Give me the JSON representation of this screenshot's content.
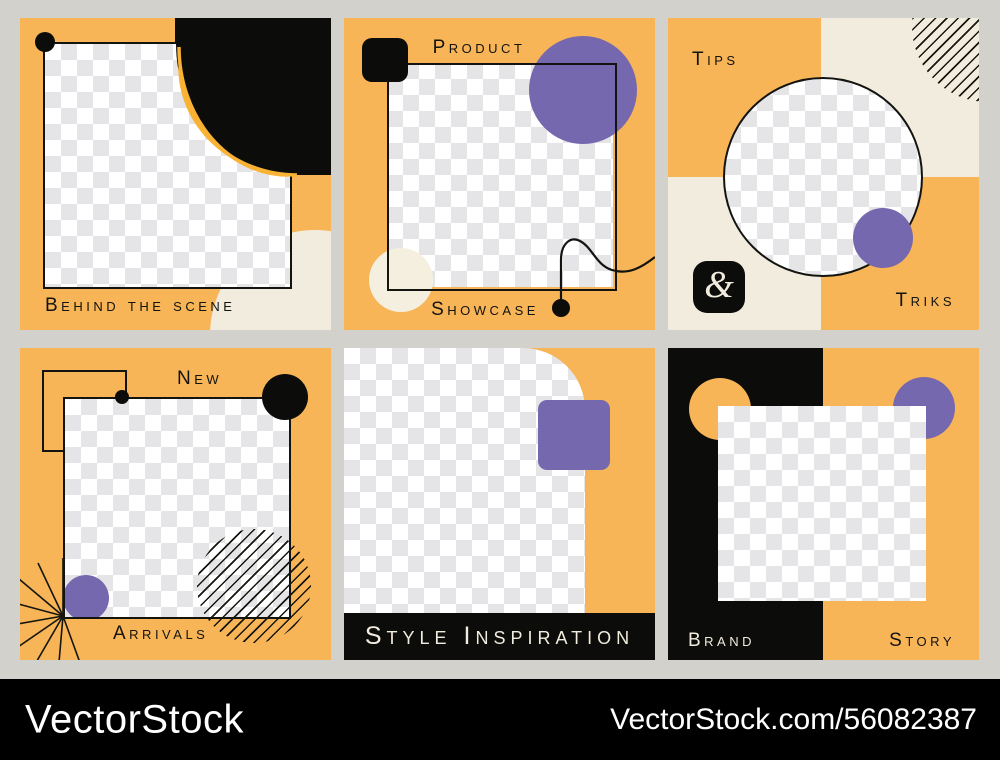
{
  "palette": {
    "background_gray": "#d2d1cc",
    "orange": "#f7b557",
    "purple": "#7568ae",
    "cream": "#f2ecde",
    "black": "#0c0c0a",
    "arc_yellow": "#f9b233"
  },
  "cards": {
    "behind_the_scene": {
      "label": "Behind the scene"
    },
    "product_showcase": {
      "label_top": "Product",
      "label_bottom": "Showcase"
    },
    "tips_triks": {
      "label_top": "Tips",
      "label_bottom": "Triks",
      "ampersand": "&"
    },
    "new_arrivals": {
      "label_top": "New",
      "label_bottom": "Arrivals"
    },
    "style_inspiration": {
      "label": "Style Inspiration"
    },
    "brand_story": {
      "label_left": "Brand",
      "label_right": "Story"
    }
  },
  "watermark": {
    "brand": "VectorStock",
    "url": "VectorStock.com/56082387"
  }
}
